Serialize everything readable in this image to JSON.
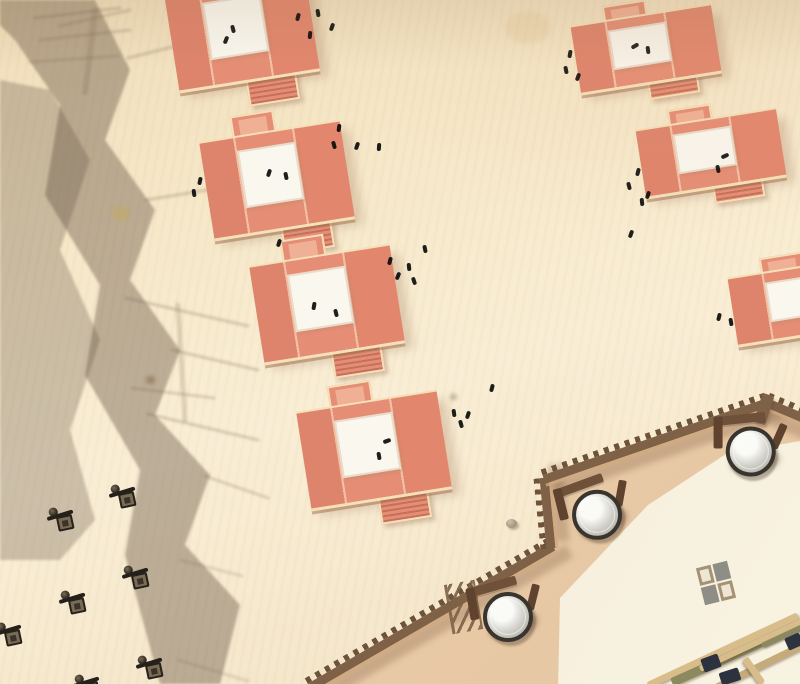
{
  "scene": {
    "width": 800,
    "height": 684,
    "kind": "aerial-fortress-courtyard"
  },
  "palette": {
    "wall": "#7e6147",
    "wallteeth": "#6d5339",
    "walllight": "#cfa97e",
    "wallshade": "rgba(130,92,66,0.30)",
    "roof": "#e58e75",
    "wingL": "#df846c",
    "wingR": "#e2876e",
    "seam": "#f2c0a3",
    "edge": "#f5e0b8",
    "edgedark": "rgba(166,118,86,0.55)",
    "white": "#faf7ee",
    "stairline": "rgba(176,92,72,0.6)",
    "innertan1": "#ecd0ae",
    "innertan2": "#e6c6a2",
    "court1": "#f3ebd4",
    "court2": "#f8f2e1",
    "drumrim": "#39342d",
    "drumf1": "#fafaf7",
    "drumf2": "#cfcec7",
    "drumf3": "#a5a39a",
    "bracket": "#6f5038",
    "drumshadow": "rgba(115,82,58,0.40)",
    "timbertan": "#d8bd8b",
    "timbertan2": "#c6ab7a",
    "timberolive": "#8a8a5e",
    "timbernavy": "#2c323e",
    "figdark": "#24201a",
    "figmid": "#7a6b55",
    "mark": "#0b0b0b",
    "checkerA": "#a59274",
    "checkerB": "#8e8e86",
    "shadowband": "rgba(104,86,70,0.42)",
    "shadowcore": "rgba(100,82,66,0.30)",
    "spike": "rgba(115,95,78,0.5)"
  },
  "shadow": {
    "band_points": "0,0 95,0 130,70 105,140 155,210 130,280 180,350 155,415 210,475 185,545 240,605 220,684 160,684 125,555 140,470 85,375 100,285 45,195 60,105 15,40 0,25",
    "core_points": "0,80 50,90 90,160 60,250 100,340 70,430 95,520 60,560 0,560",
    "spikes": [
      [
        35,
        18,
        120,
        8,
        3,
        0.5
      ],
      [
        40,
        40,
        130,
        30,
        3,
        0.45
      ],
      [
        30,
        62,
        118,
        56,
        3,
        0.4
      ],
      [
        60,
        26,
        130,
        10,
        3,
        0.45
      ],
      [
        95,
        10,
        85,
        92,
        6,
        0.4
      ],
      [
        128,
        58,
        208,
        38,
        3,
        0.5
      ],
      [
        146,
        200,
        232,
        186,
        3,
        0.5
      ],
      [
        126,
        298,
        248,
        326,
        3,
        0.5
      ],
      [
        172,
        350,
        258,
        370,
        3,
        0.5
      ],
      [
        132,
        388,
        214,
        398,
        3,
        0.45
      ],
      [
        148,
        414,
        258,
        440,
        3,
        0.5
      ],
      [
        178,
        305,
        185,
        420,
        5,
        0.4
      ],
      [
        205,
        476,
        268,
        498,
        3,
        0.45
      ],
      [
        180,
        560,
        242,
        576,
        3,
        0.35
      ],
      [
        178,
        660,
        248,
        681,
        3,
        0.35
      ]
    ]
  },
  "fortress": {
    "inner_ground_points": [
      [
        308,
        690
      ],
      [
        553,
        545
      ],
      [
        546,
        477
      ],
      [
        768,
        401
      ],
      [
        806,
        417
      ],
      [
        806,
        690
      ]
    ],
    "courtyard_points": [
      [
        558,
        690
      ],
      [
        560,
        598
      ],
      [
        648,
        505
      ],
      [
        726,
        454
      ],
      [
        806,
        440
      ],
      [
        806,
        690
      ]
    ],
    "wall_segments": [
      {
        "x1": 310,
        "y1": 687,
        "x2": 553,
        "y2": 546
      },
      {
        "x1": 551,
        "y1": 548,
        "x2": 544,
        "y2": 477
      },
      {
        "x1": 544,
        "y1": 479,
        "x2": 768,
        "y2": 402
      },
      {
        "x1": 766,
        "y1": 402,
        "x2": 804,
        "y2": 418
      }
    ],
    "brace": {
      "x": 448,
      "y": 582,
      "w": 26,
      "h": 50,
      "rot": -10
    },
    "post": {
      "x": 758,
      "y": 394,
      "w": 12,
      "h": 30,
      "rot": 18
    },
    "drums": [
      {
        "x": 564,
        "y": 484,
        "rot": -4
      },
      {
        "x": 475,
        "y": 586,
        "rot": 0
      },
      {
        "x": 718,
        "y": 420,
        "rot": 10
      }
    ],
    "checker": {
      "x": 700,
      "y": 564,
      "w": 32,
      "h": 38,
      "rot": -14
    },
    "pebble": {
      "x": 506,
      "y": 519
    },
    "timber_beams": [
      [
        648,
        682,
        165,
        7,
        -25,
        "timbertan"
      ],
      [
        672,
        678,
        140,
        9,
        -24,
        "timberolive"
      ],
      [
        700,
        666,
        115,
        6,
        -25,
        "timbertan"
      ],
      [
        716,
        684,
        110,
        7,
        -26,
        "timbertan2"
      ],
      [
        745,
        655,
        30,
        7,
        55,
        "timbertan"
      ],
      [
        762,
        643,
        60,
        5,
        -25,
        "timberolive"
      ]
    ],
    "timber_blocks": [
      [
        702,
        656,
        18,
        14,
        -20
      ],
      [
        720,
        670,
        20,
        13,
        -18
      ],
      [
        786,
        635,
        16,
        13,
        -24
      ]
    ]
  },
  "buildings": [
    {
      "x": 171,
      "y": -16,
      "w": 142,
      "h": 96
    },
    {
      "x": 206,
      "y": 132,
      "w": 142,
      "h": 96
    },
    {
      "x": 256,
      "y": 256,
      "w": 142,
      "h": 96
    },
    {
      "x": 303,
      "y": 402,
      "w": 142,
      "h": 96
    },
    {
      "x": 575,
      "y": 16,
      "w": 142,
      "h": 66
    },
    {
      "x": 640,
      "y": 120,
      "w": 142,
      "h": 66
    },
    {
      "x": 732,
      "y": 268,
      "w": 142,
      "h": 66
    }
  ],
  "people_marks": [
    [
      296,
      13,
      15
    ],
    [
      316,
      9,
      -10
    ],
    [
      330,
      23,
      20
    ],
    [
      308,
      31,
      5
    ],
    [
      231,
      25,
      -15
    ],
    [
      224,
      36,
      22
    ],
    [
      198,
      177,
      12
    ],
    [
      192,
      189,
      -8
    ],
    [
      267,
      169,
      18
    ],
    [
      284,
      172,
      -12
    ],
    [
      337,
      124,
      8
    ],
    [
      332,
      141,
      -16
    ],
    [
      355,
      142,
      20
    ],
    [
      377,
      143,
      4
    ],
    [
      423,
      245,
      -12
    ],
    [
      388,
      257,
      16
    ],
    [
      407,
      263,
      -6
    ],
    [
      396,
      272,
      22
    ],
    [
      412,
      277,
      -18
    ],
    [
      312,
      302,
      10
    ],
    [
      334,
      309,
      -14
    ],
    [
      277,
      239,
      18
    ],
    [
      385,
      437,
      70
    ],
    [
      377,
      452,
      -10
    ],
    [
      490,
      384,
      14
    ],
    [
      452,
      409,
      -8
    ],
    [
      466,
      411,
      18
    ],
    [
      459,
      420,
      -16
    ],
    [
      568,
      50,
      10
    ],
    [
      564,
      66,
      -12
    ],
    [
      576,
      73,
      20
    ],
    [
      633,
      42,
      60
    ],
    [
      646,
      46,
      -8
    ],
    [
      636,
      168,
      14
    ],
    [
      627,
      182,
      -14
    ],
    [
      646,
      191,
      18
    ],
    [
      640,
      198,
      -6
    ],
    [
      629,
      230,
      20
    ],
    [
      723,
      152,
      65
    ],
    [
      716,
      165,
      -12
    ],
    [
      717,
      313,
      14
    ],
    [
      729,
      318,
      -10
    ]
  ],
  "desk_units": [
    [
      110,
      486
    ],
    [
      48,
      509
    ],
    [
      123,
      567
    ],
    [
      60,
      592
    ],
    [
      -4,
      624
    ],
    [
      137,
      657
    ],
    [
      74,
      676
    ]
  ],
  "stains": [
    {
      "x": 112,
      "y": 206,
      "w": 18,
      "h": 15,
      "c": "rgba(196,170,90,0.5)"
    },
    {
      "x": 146,
      "y": 376,
      "w": 9,
      "h": 8,
      "c": "rgba(120,90,50,0.5)"
    },
    {
      "x": 450,
      "y": 394,
      "w": 7,
      "h": 6,
      "c": "rgba(90,70,40,0.4)"
    },
    {
      "x": 505,
      "y": 12,
      "w": 46,
      "h": 32,
      "c": "rgba(224,196,148,0.28)"
    }
  ]
}
